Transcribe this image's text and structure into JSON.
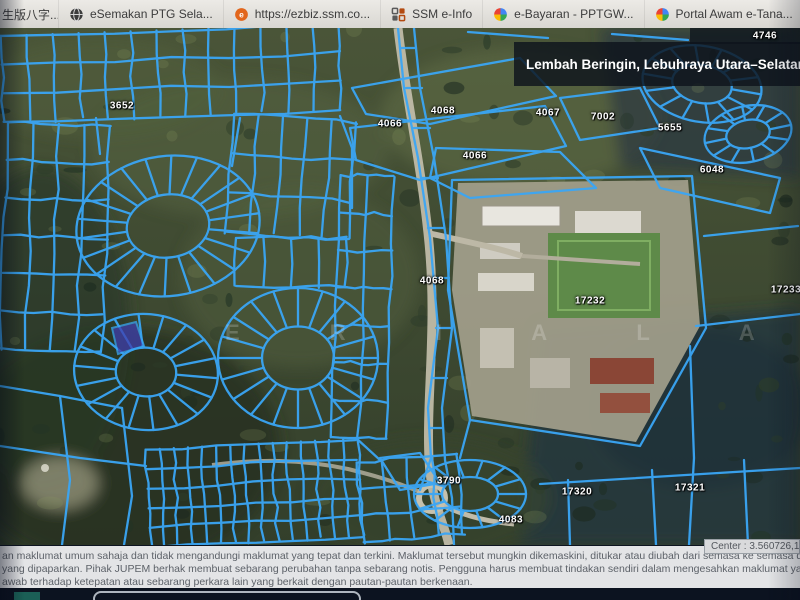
{
  "browser": {
    "tabs": [
      {
        "label": "生版八字...",
        "icon": "document-icon"
      },
      {
        "label": "eSemakan PTG Sela...",
        "icon": "globe-icon"
      },
      {
        "label": "https://ezbiz.ssm.co...",
        "icon": "orange-dot-icon"
      },
      {
        "label": "SSM e-Info",
        "icon": "squares-icon"
      },
      {
        "label": "e-Bayaran - PPTGW...",
        "icon": "colorful-globe-icon"
      },
      {
        "label": "Portal Awam e-Tana...",
        "icon": "colorful-globe-icon"
      }
    ],
    "overflow_chevron": "»"
  },
  "map": {
    "location_banner": "Lembah Beringin, Lebuhraya Utara–Selatan, L",
    "watermark": "E R I A L A",
    "center_readout": "Center : 3.560726,101.",
    "parcels": [
      {
        "label": "4746"
      },
      {
        "label": "3652"
      },
      {
        "label": "4068"
      },
      {
        "label": "4066"
      },
      {
        "label": "4067"
      },
      {
        "label": "7002"
      },
      {
        "label": "5655"
      },
      {
        "label": "4066"
      },
      {
        "label": "6048"
      },
      {
        "label": "4068"
      },
      {
        "label": "17232"
      },
      {
        "label": "17233"
      },
      {
        "label": "3790"
      },
      {
        "label": "17320"
      },
      {
        "label": "17321"
      },
      {
        "label": "4083"
      }
    ],
    "colors": {
      "parcel_line": "#3aa6f5",
      "highlight_lot": "#3f3fae",
      "banner_bg": "rgba(14,20,28,0.82)"
    }
  },
  "disclaimer": {
    "lines": [
      "an maklumat umum sahaja dan tidak mengandungi maklumat yang tepat dan terkini. Maklumat tersebut mungkin dikemaskini, ditukar atau diubah dari semasa ke semasa dan pihak Jabatan Ukur dan",
      "yang dipaparkan. Pihak JUPEM berhak membuat sebarang perubahan tanpa sebarang notis. Pengguna harus membuat tindakan sendiri dalam mengesahkan maklumat yang ada sebelum menggunak",
      "awab terhadap ketepatan atau sebarang perkara lain yang berkait dengan pautan-pautan berkenaan."
    ]
  }
}
